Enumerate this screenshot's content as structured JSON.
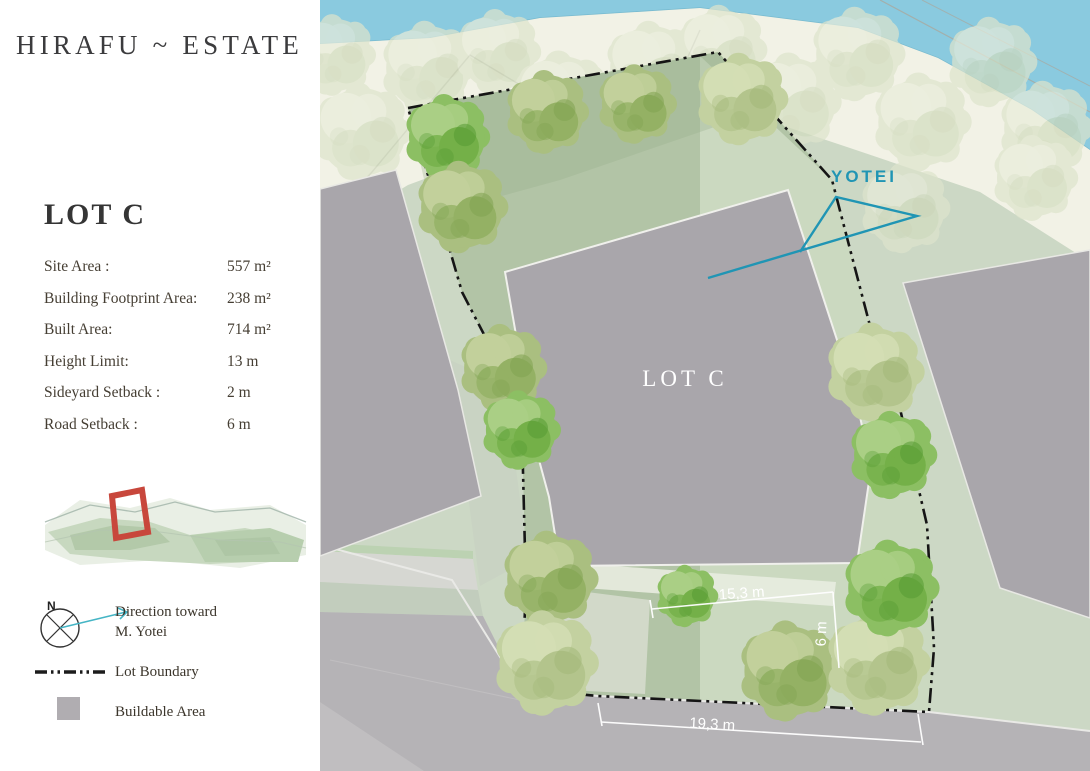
{
  "brand": {
    "title": "HIRAFU ~ ESTATE"
  },
  "lot": {
    "heading": "LOT C",
    "details": [
      {
        "label": "Site Area :",
        "value": "557 m²"
      },
      {
        "label": "Building Footprint Area:",
        "value": "238 m²"
      },
      {
        "label": "Built Area:",
        "value": "714 m²"
      },
      {
        "label": "Height Limit:",
        "value": "13 m"
      },
      {
        "label": "Sideyard Setback :",
        "value": "2 m"
      },
      {
        "label": "Road Setback :",
        "value": "6 m"
      }
    ]
  },
  "legend": {
    "compass_north": "N",
    "direction_line1": "Direction toward",
    "direction_line2": "M. Yotei",
    "lot_boundary": "Lot Boundary",
    "buildable_area": "Buildable Area"
  },
  "map": {
    "lot_label": "LOT C",
    "mountain_label": "YOTEI",
    "dimensions": {
      "front_width": "15,3 m",
      "setback_depth": "6 m",
      "road_frontage": "19,3 m"
    }
  },
  "colors": {
    "teal_accent": "#2095b4",
    "boundary_black": "#151515",
    "buildable_gray": "#aaa7ad",
    "lot_marker_red": "#c8473c",
    "river_blue": "#8acadf",
    "lot_green": "#b2c4a6"
  }
}
